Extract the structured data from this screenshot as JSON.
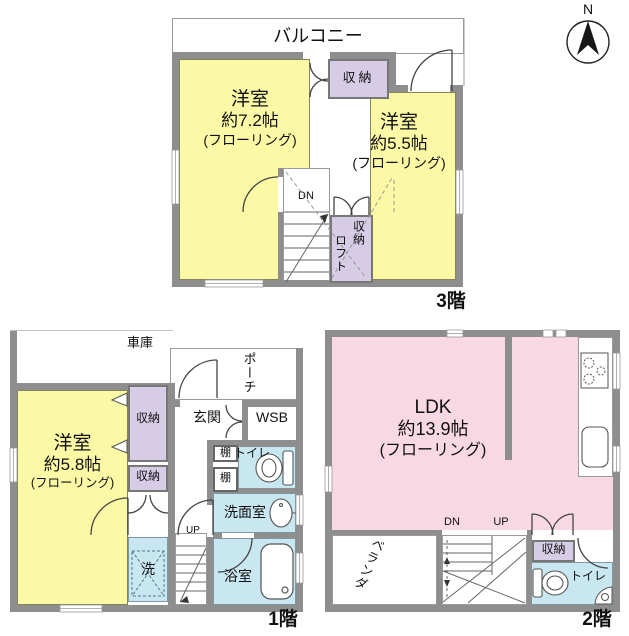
{
  "compass": {
    "north": "N"
  },
  "colors": {
    "wall": "#8e8e8e",
    "room_yellow": "#fbf9a6",
    "room_pink": "#f8d8e2",
    "closet_lavender": "#d6cce6",
    "wet_blue": "#c9e7f1"
  },
  "floor3": {
    "label": "3階",
    "balcony": "バルコニー",
    "room_west": {
      "name": "洋室",
      "size": "約7.2帖",
      "finish": "(フローリング)"
    },
    "room_east": {
      "name": "洋室",
      "size": "約5.5帖",
      "finish": "(フローリング)"
    },
    "closet_top": "収納",
    "closet_loft": {
      "closet": "収納",
      "loft": "ロフト"
    },
    "dn": "DN"
  },
  "floor1": {
    "label": "1階",
    "garage": "車庫",
    "porch": "ポーチ",
    "entrance": "玄関",
    "wsb": "WSB",
    "room": {
      "name": "洋室",
      "size": "約5.8帖",
      "finish": "(フローリング)"
    },
    "closet_upper": "収納",
    "closet_lower": "収納",
    "shelf_upper": "棚",
    "shelf_lower": "棚",
    "toilet": "トイレ",
    "washroom": "洗面室",
    "laundry": "洗",
    "up": "UP",
    "bathroom": "浴室"
  },
  "floor2": {
    "label": "2階",
    "ldk": {
      "name": "LDK",
      "size": "約13.9帖",
      "finish": "(フローリング)"
    },
    "veranda": "ベランダ",
    "dn": "DN",
    "up": "UP",
    "closet": "収納",
    "toilet": "トイレ"
  }
}
